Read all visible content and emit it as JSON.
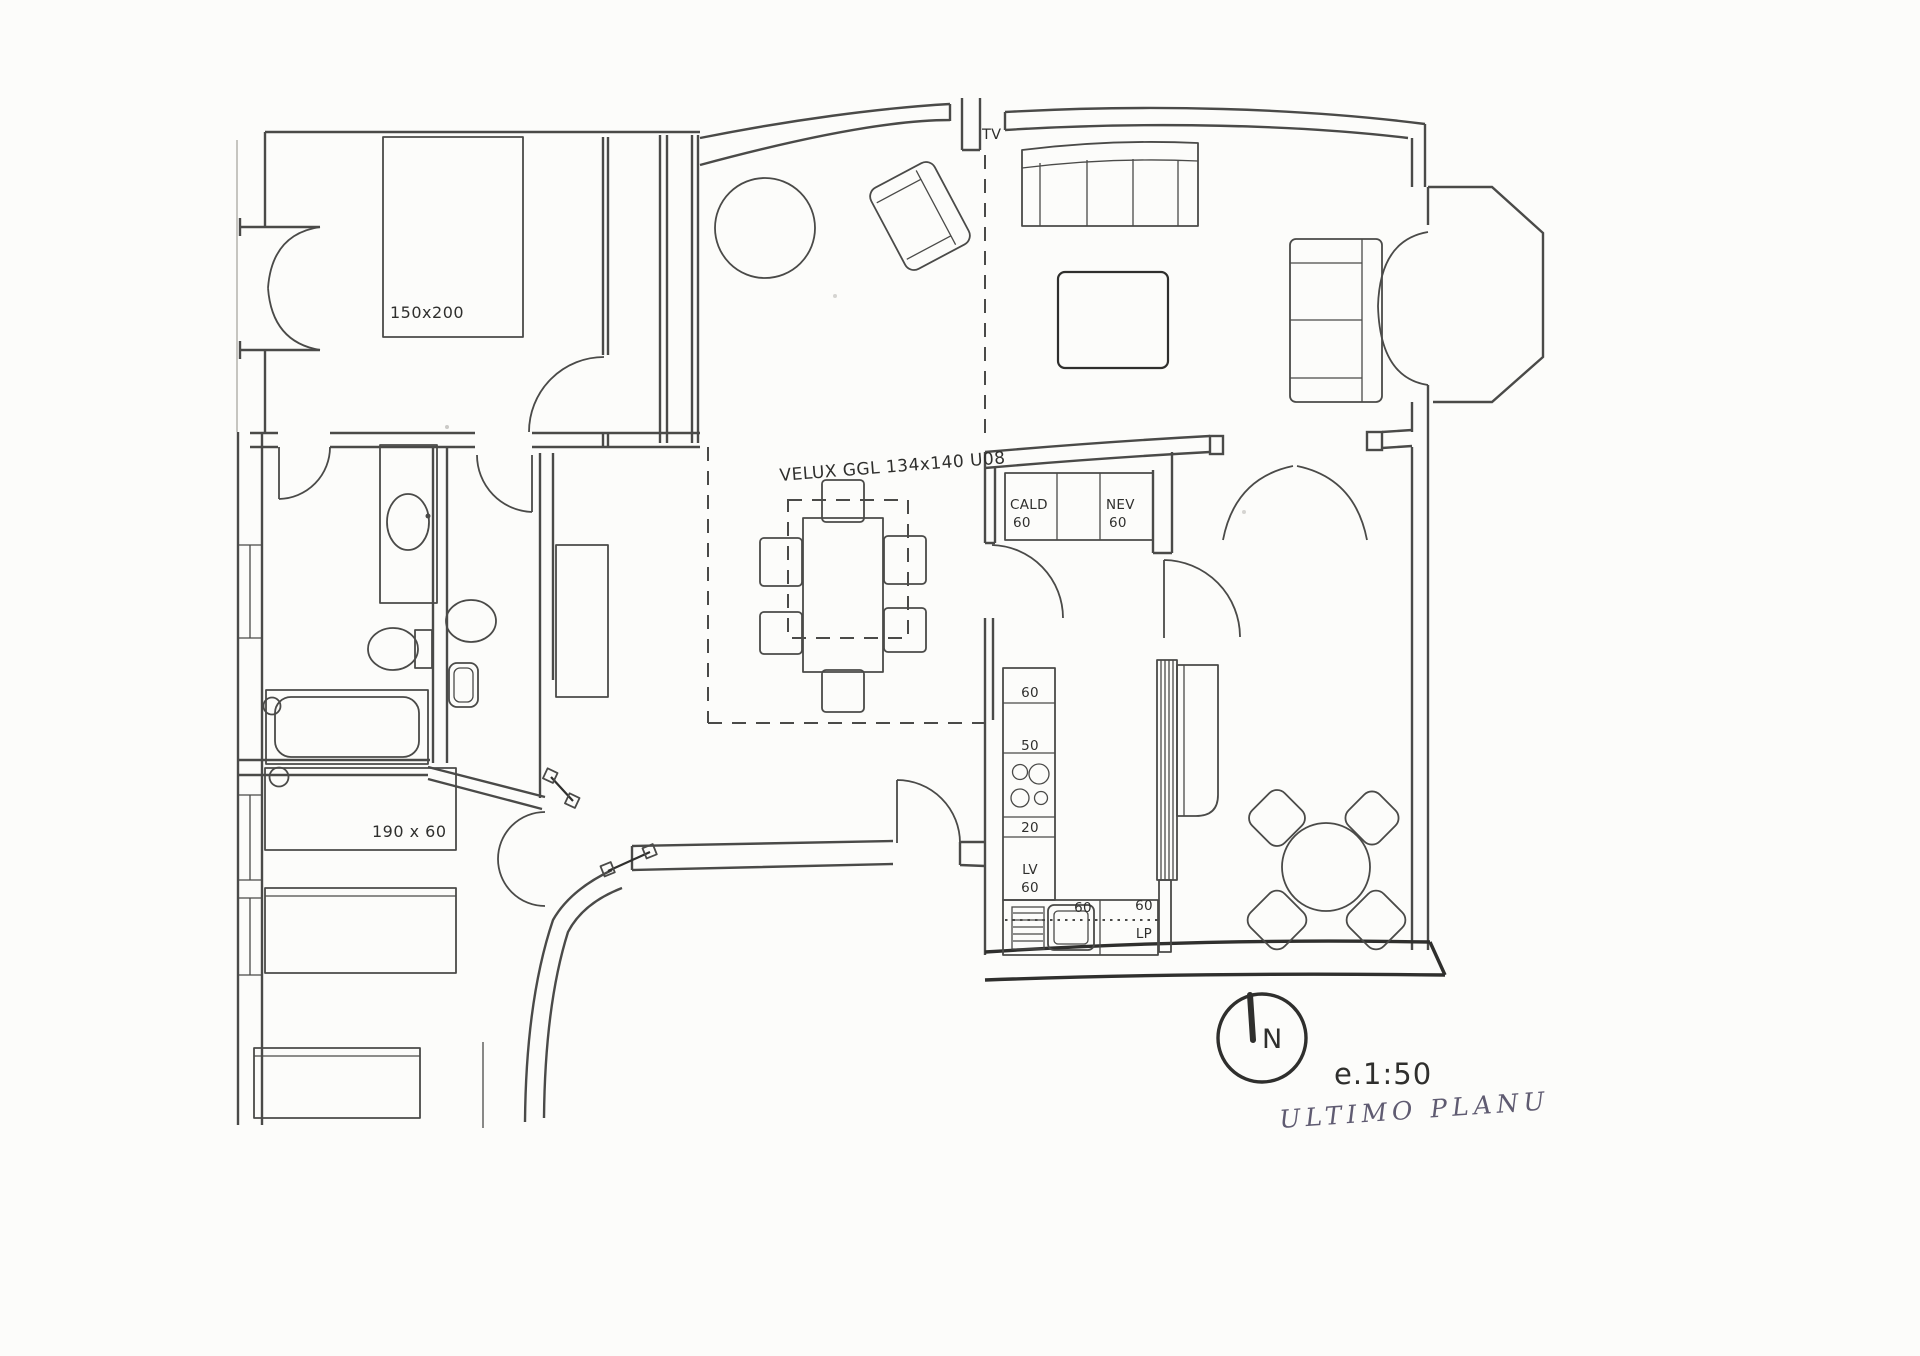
{
  "plan": {
    "labels": {
      "bed_master": "150x200",
      "velux": "VELUX GGL 134x140 U08",
      "tv": "TV",
      "cald": "CALD",
      "cald_size": "60",
      "nev": "NEV",
      "nev_size": "60",
      "col_60": "60",
      "col_50": "50",
      "col_20": "20",
      "lv": "LV",
      "lv_size": "60",
      "sink_size": "60",
      "row_size": "60",
      "lp": "LP",
      "bed_child": "190 x 60",
      "compass_n": "N",
      "scale": "e.1:50",
      "handwritten_note": "ULTIMO PLANU"
    },
    "colors": {
      "ink": "#4a4a48",
      "ink_dark": "#2f2f2d",
      "paper": "#fcfcfa",
      "handwriting": "#4f4a63"
    }
  }
}
